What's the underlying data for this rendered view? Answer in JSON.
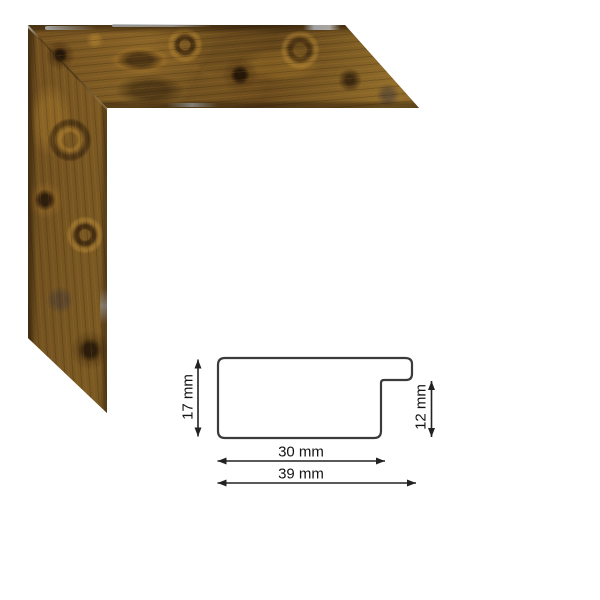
{
  "image": {
    "background_color": "#ffffff",
    "type_note": "picture frame moulding corner sample with dimensioned cross-section"
  },
  "frame_sample": {
    "colors": {
      "wood_base": "#7a5622",
      "wood_dark_knot": "#2a180a",
      "wood_gold_highlight": "#c09a40",
      "edge_highlight_silver": "#aab0b6"
    }
  },
  "diagram": {
    "line_color": "#3b3b3b",
    "arrow_color": "#222222",
    "text_color": "#141414",
    "labels": {
      "profile_height": "17 mm",
      "rebate_depth": "12 mm",
      "face_width": "30 mm",
      "overall_width": "39 mm"
    }
  }
}
